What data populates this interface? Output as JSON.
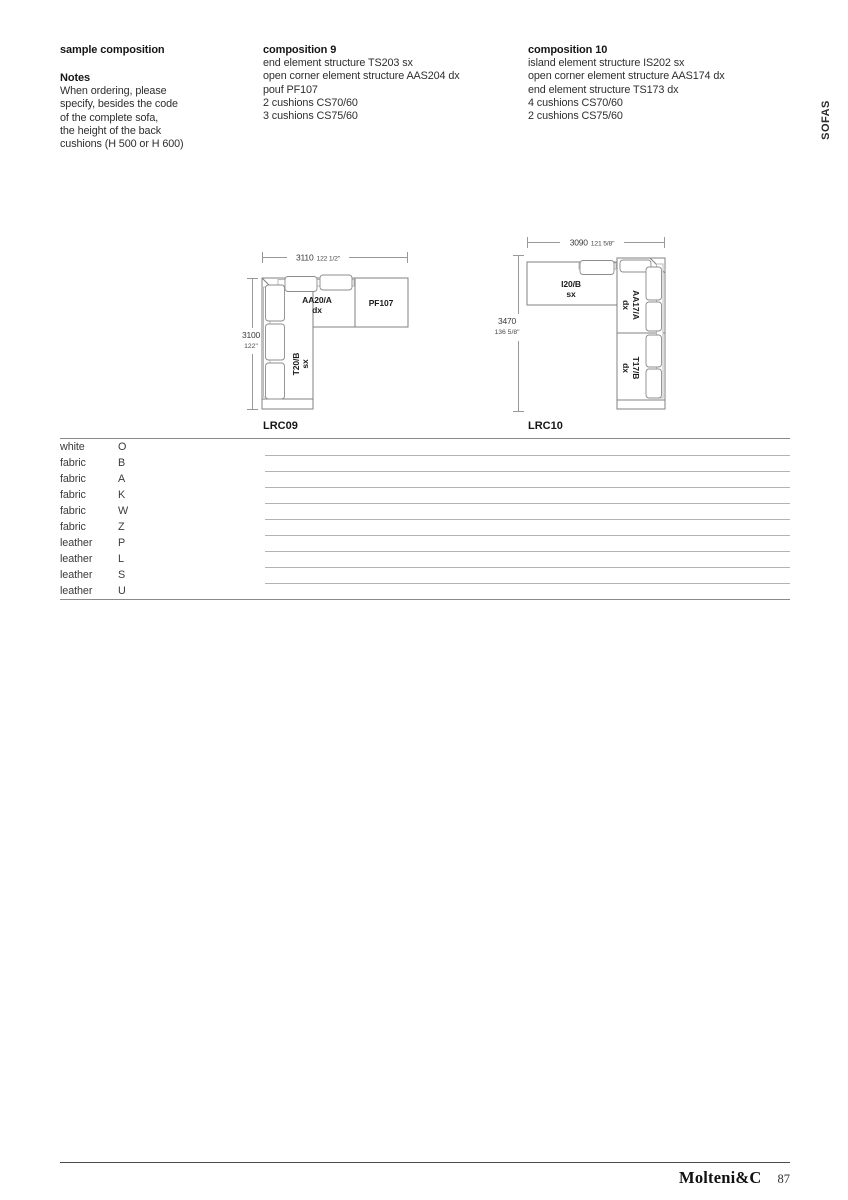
{
  "page": {
    "side_tab": "SOFAS",
    "footer_brand": "Molteni&C",
    "footer_page_number": "87"
  },
  "sample": {
    "title": "sample composition",
    "notes_title": "Notes",
    "notes_lines": [
      "When ordering, please",
      "specify, besides the code",
      "of the complete sofa,",
      "the height of the back",
      "cushions (H 500 or H 600)"
    ]
  },
  "composition9": {
    "title": "composition 9",
    "lines": [
      "end element structure TS203 sx",
      "open corner element structure AAS204 dx",
      "pouf PF107",
      "2 cushions CS70/60",
      "3 cushions CS75/60"
    ]
  },
  "composition10": {
    "title": "composition 10",
    "lines": [
      "island element structure IS202 sx",
      "open corner element structure AAS174 dx",
      "end element structure TS173 dx",
      "4 cushions CS70/60",
      "2 cushions CS75/60"
    ]
  },
  "diagrams": {
    "lrc09": {
      "code": "LRC09",
      "dim_width_mm": "3110",
      "dim_width_in": "122 1/2\"",
      "dim_height_mm": "3100",
      "dim_height_in": "122\"",
      "element_corner": "AA20/A",
      "element_corner_side": "dx",
      "element_pouf": "PF107",
      "element_end": "T20/B",
      "element_end_side": "sx"
    },
    "lrc10": {
      "code": "LRC10",
      "dim_width_mm": "3090",
      "dim_width_in": "121 5/8\"",
      "dim_height_mm": "3470",
      "dim_height_in": "136 5/8\"",
      "element_island": "I20/B",
      "element_island_side": "sx",
      "element_corner": "AA17/A",
      "element_corner_side": "dx",
      "element_end": "T17/B",
      "element_end_side": "dx"
    }
  },
  "price_table": {
    "rows": [
      {
        "material": "white",
        "code": "O"
      },
      {
        "material": "fabric",
        "code": "B"
      },
      {
        "material": "fabric",
        "code": "A"
      },
      {
        "material": "fabric",
        "code": "K"
      },
      {
        "material": "fabric",
        "code": "W"
      },
      {
        "material": "fabric",
        "code": "Z"
      },
      {
        "material": "leather",
        "code": "P"
      },
      {
        "material": "leather",
        "code": "L"
      },
      {
        "material": "leather",
        "code": "S"
      },
      {
        "material": "leather",
        "code": "U"
      }
    ]
  },
  "colors": {
    "text": "#262626",
    "rule_dark": "#8a8a8a",
    "rule_light": "#b3b3b3",
    "diagram_outline": "#808080"
  }
}
